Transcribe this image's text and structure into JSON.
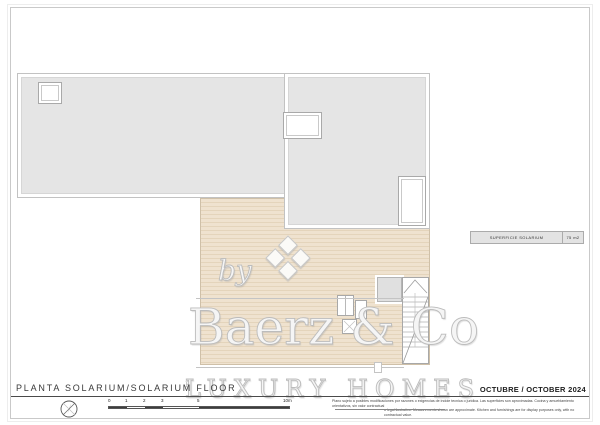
{
  "page": {
    "title": "PLANTA SOLARIUM/SOLARIUM FLOOR",
    "date": "OCTUBRE / OCTOBER 2024"
  },
  "legend": {
    "area_label": "SUPERFICIE SOLARIUM",
    "area_value": "75 m2"
  },
  "watermark": {
    "by": "by",
    "brand": "Baerz & Co",
    "tagline": "LUXURY HOMES",
    "registered": "R"
  },
  "scalebar": {
    "labels": [
      "0",
      "1",
      "2",
      "3",
      "5",
      "10m"
    ]
  },
  "disclaimer": {
    "line1": "Plano sujeto a posibles modificaciones por razones o exigencias de indole tecnica o juridica. Las superficies son aproximadas. Cocina y amueblamiento orientativos, sin valor contractual",
    "line2": "o legal ilustrativo. Measurements shown are approximate. Kitchen and furnishings are for display purposes only, with no contractual value."
  },
  "icons": {
    "compass": "compass-icon"
  },
  "colors": {
    "roof_fill": "#e5e5e5",
    "terrace_fill": "#efe2cf",
    "terrace_line": "#e4d4bb",
    "ink": "#3d3d3d",
    "watermark": "#bcbcbc"
  }
}
